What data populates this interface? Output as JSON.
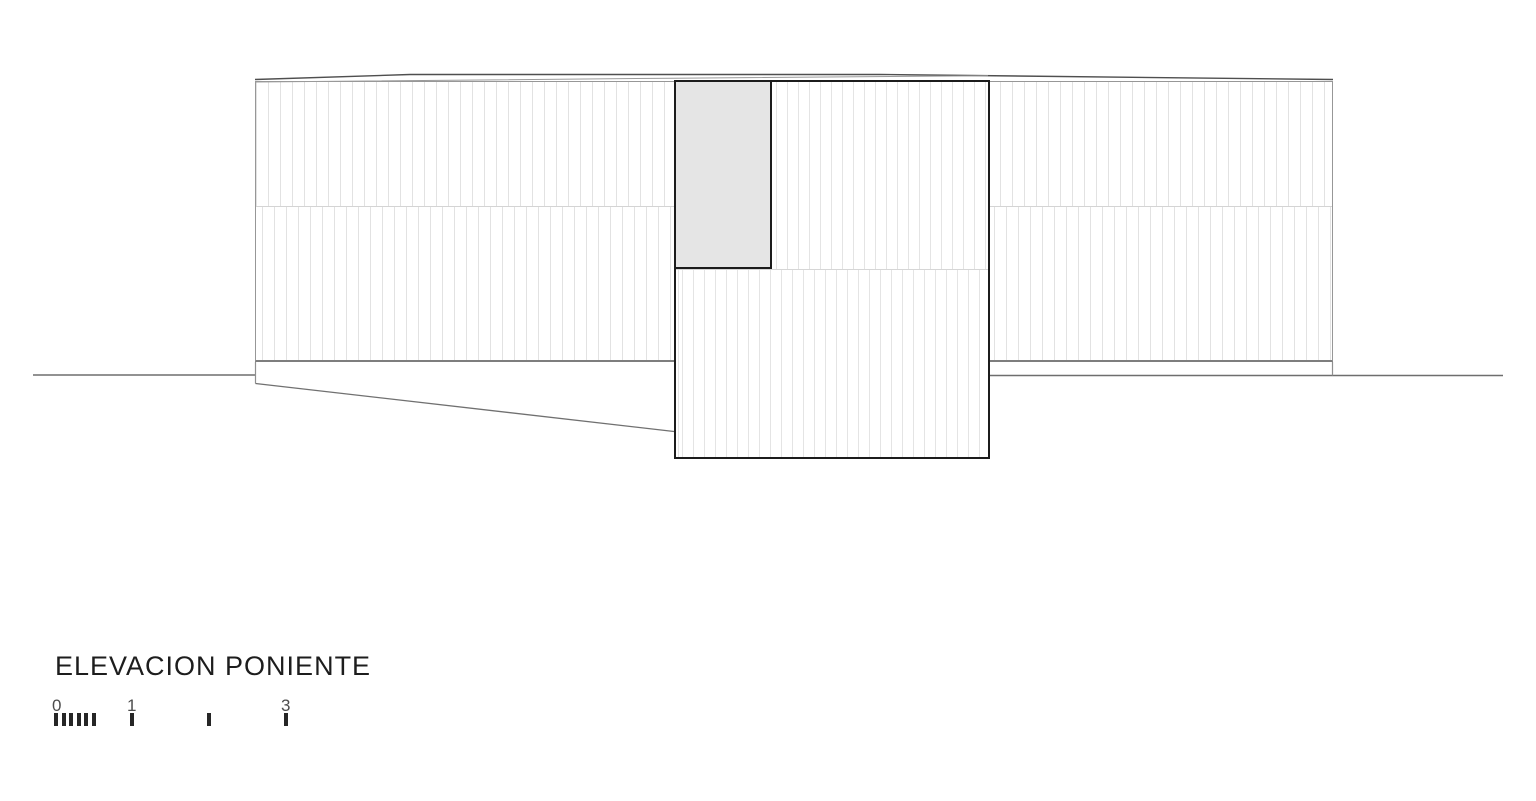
{
  "drawing": {
    "title": "ELEVACION PONIENTE"
  },
  "scale_bar": {
    "label_0": "0",
    "label_1": "1",
    "label_3": "3"
  },
  "colors": {
    "background": "#ffffff",
    "facade_outline": "#979797",
    "facade_bottom_edge": "#7e7e7e",
    "tower_outline": "#1c1c1c",
    "cladding_line": "#e2e2e2",
    "division_line": "#d4d4d4",
    "panel_fill": "#e5e5e5",
    "roof_line": "#4f4f4f",
    "ground_line": "#6e6e6e",
    "ramp_line": "#707070",
    "title_text": "#1d1d1d",
    "scale_label_text": "#4d4d4d",
    "scale_tick": "#262626"
  }
}
